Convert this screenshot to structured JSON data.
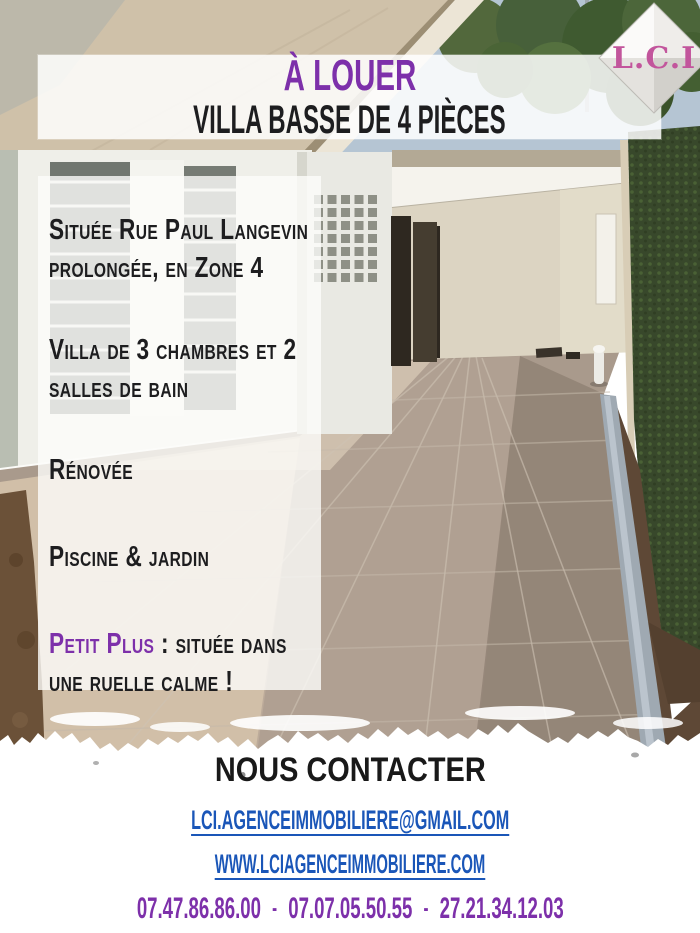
{
  "colors": {
    "accent_purple": "#7d30aa",
    "link_blue": "#1a56b8",
    "logo_pink": "#c2559c",
    "heading_black": "#1d1d1f"
  },
  "logo": {
    "text": "L.C.I"
  },
  "header": {
    "title": "À LOUER",
    "subtitle": "VILLA BASSE DE 4 PIÈCES"
  },
  "details": {
    "items": [
      {
        "highlight": "",
        "text": "Située Rue Paul Langevin prolongée, en Zone 4"
      },
      {
        "highlight": "",
        "text": "Villa de 3 chambres et 2 salles de bain"
      },
      {
        "highlight": "",
        "text": "Rénovée"
      },
      {
        "highlight": "",
        "text": "Piscine & jardin"
      },
      {
        "highlight": "Petit Plus",
        "text": " : située dans une ruelle calme !"
      }
    ]
  },
  "contact": {
    "heading": "NOUS CONTACTER",
    "email": "LCI.AGENCEIMMOBILIERE@GMAIL.COM",
    "website": "WWW.LCIAGENCEIMMOBILIERE.COM",
    "separator": "-",
    "phones": [
      "07.47.86.86.00",
      "07.07.05.50.55",
      "27.21.34.12.03"
    ]
  }
}
